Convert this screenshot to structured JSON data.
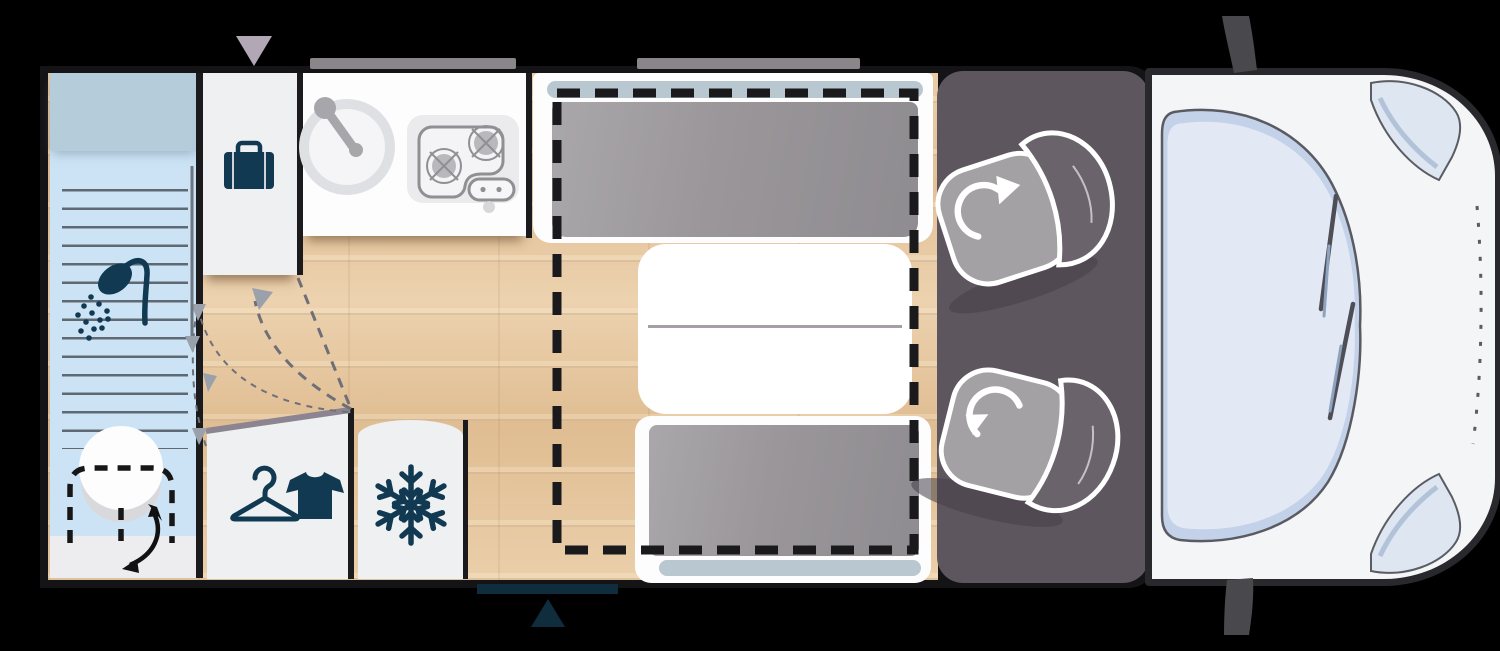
{
  "page": {
    "title": "Motorhome floor plan - top view diagram",
    "type": "floorplan"
  },
  "colors": {
    "background": "#000000",
    "floor_wood": "#e5c49c",
    "bathroom_blue": "#cbe3f5",
    "bathroom_band": "#b5ccda",
    "furniture_white": "#eff0f1",
    "icon_teal": "#113a52",
    "cushion_gray": "#9a969a",
    "headrest_blue_gray": "#b9c7d1",
    "cab_gray": "#5e565e",
    "seat_gray": "#a4a1a5",
    "backrest_gray": "#6b636c",
    "body_white": "#f4f5f7",
    "windshield_blue": "#e2e9f4",
    "outline_dark": "#28282d",
    "bed_dash_black": "#1a1a1d",
    "entry_teal": "#0f2d3d",
    "roof_bar_gray": "#8a8589",
    "top_marker_mauve": "#b2a7b4"
  },
  "zones": [
    {
      "id": "shower-room",
      "icons": [
        "shower-head-icon",
        "swivel-toilet",
        "sliding-door-arrow"
      ]
    },
    {
      "id": "storage-cabinet",
      "icons": [
        "suitcase-icon"
      ]
    },
    {
      "id": "kitchen-block",
      "icons": [
        "sink-icon",
        "two-burner-hob-icon"
      ]
    },
    {
      "id": "dinette",
      "parts": [
        "front-bench",
        "folding-table",
        "rear-bench",
        "drop-down-bed-dashed-outline"
      ]
    },
    {
      "id": "wardrobe",
      "icons": [
        "hanger-icon",
        "tshirt-icon"
      ]
    },
    {
      "id": "fridge",
      "icons": [
        "snowflake-icon"
      ]
    },
    {
      "id": "driver-cab",
      "parts": [
        "swivel-seat-top",
        "swivel-seat-bottom"
      ]
    },
    {
      "id": "vehicle-front",
      "parts": [
        "windshield",
        "wipers",
        "headlight-top",
        "headlight-bottom",
        "mirror-top",
        "mirror-bottom",
        "hood-dashed-line"
      ]
    },
    {
      "id": "entry",
      "parts": [
        "entry-step",
        "entry-arrow-triangle"
      ]
    }
  ],
  "markers": {
    "roof_bars_count": 2,
    "top_triangle_marker": "mauve-down-triangle",
    "entry_triangle_marker": "teal-up-triangle"
  }
}
